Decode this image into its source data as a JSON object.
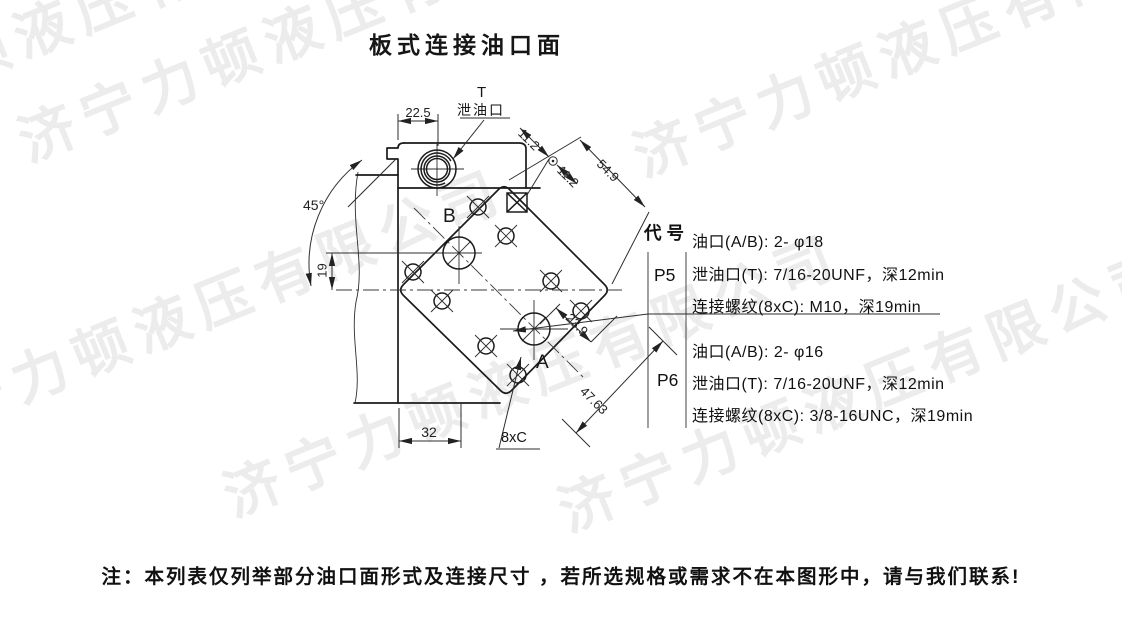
{
  "title": "板式连接油口面",
  "drawing": {
    "labels": {
      "drain_symbol": "T",
      "drain_port": "泄油口",
      "port_b": "B",
      "port_a": "A",
      "bolt_pattern": "8xC"
    },
    "dims": {
      "top_width": "22.5",
      "seg_a": "11.2",
      "seg_b": "11.2",
      "diag_total": "54.9",
      "angle": "45°",
      "height_left": "19",
      "bottom_width": "32",
      "port_offset": "23.9",
      "bolt_span": "47.63"
    }
  },
  "spec_table": {
    "header": "代号",
    "rows": [
      {
        "code": "P5",
        "lines": [
          "油口(A/B): 2- φ18",
          "泄油口(T): 7/16-20UNF，深12min",
          "连接螺纹(8xC): M10，深19min"
        ]
      },
      {
        "code": "P6",
        "lines": [
          "油口(A/B): 2- φ16",
          "泄油口(T): 7/16-20UNF，深12min",
          "连接螺纹(8xC): 3/8-16UNC，深19min"
        ]
      }
    ]
  },
  "note": "注：本列表仅列举部分油口面形式及连接尺寸 ，若所选规格或需求不在本图形中，请与我们联系!",
  "watermark": {
    "text": "济宁力顿液压有限公司",
    "color": "#ececec"
  }
}
